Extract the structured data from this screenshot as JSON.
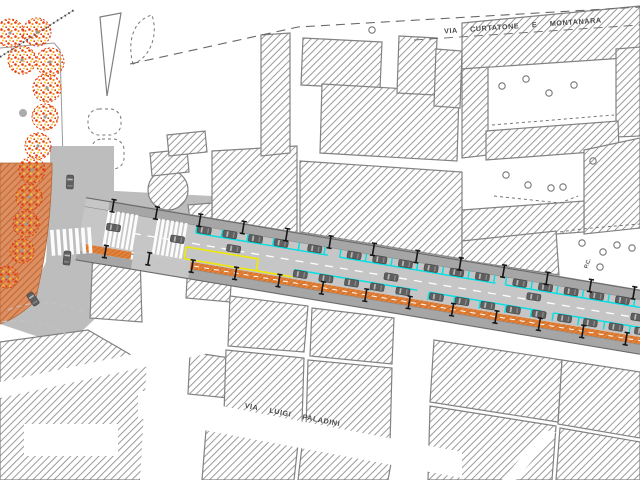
{
  "drawing": {
    "kind": "urban street redesign plan",
    "labels": {
      "street_top": "VIA CURTATONE E MONTANARA",
      "street_bottom": "VIA LUIGI PALADINI",
      "marker": "P.C."
    }
  },
  "colors": {
    "plaza": "#dd8f62",
    "plaza_hatch": "#c06a35",
    "bike": "#e2823a",
    "bike_hatch": "#c96a28",
    "parking_cyan": "#00dfe3",
    "bus_yellow": "#f0ea00",
    "road": "#c6c6c6",
    "sidewalk": "#a6a6a6",
    "junction": "#bdbdbd",
    "car_body": "#5f5f5f",
    "hatch_line": "#9a9a9a",
    "outline": "#828282",
    "tree_red": "#e23b0e",
    "tree_orange": "#f58a1f",
    "tree_yellow": "#f7c81e"
  },
  "map": {
    "road": {
      "origin_x": 88,
      "origin_y": 198,
      "angle_deg": 9.5,
      "length": 615
    },
    "parked_cars_north_x": [
      120,
      146,
      172,
      198,
      232,
      272,
      298,
      324,
      350,
      376,
      402,
      440,
      466,
      492,
      518,
      544,
      570
    ],
    "parked_cars_south_x": [
      222,
      248,
      274,
      300,
      326,
      360,
      386,
      412,
      438,
      464,
      490,
      516,
      542,
      568
    ],
    "moving_cars": [
      [
        30,
        25
      ],
      [
        95,
        26
      ],
      [
        152,
        26
      ],
      [
        312,
        28
      ],
      [
        456,
        24
      ],
      [
        562,
        27
      ]
    ],
    "road_trees_x": [
      26,
      70,
      114,
      158,
      202,
      246,
      290,
      334,
      378,
      422,
      466,
      510,
      554,
      598
    ],
    "parking_bays_north": [
      [
        112,
        246
      ],
      [
        258,
        416
      ],
      [
        426,
        586
      ]
    ],
    "parking_bays_south": [
      [
        216,
        340
      ],
      [
        352,
        466
      ],
      [
        478,
        586
      ]
    ],
    "crosswalks_local_x": [
      22,
      72
    ],
    "junction_cars": [
      [
        70,
        182,
        92
      ],
      [
        67,
        258,
        96
      ],
      [
        33,
        299,
        55
      ]
    ],
    "park_trees": [
      [
        10,
        33,
        14
      ],
      [
        37,
        32,
        14
      ],
      [
        22,
        60,
        14
      ],
      [
        50,
        62,
        14
      ],
      [
        47,
        88,
        14
      ],
      [
        45,
        117,
        13
      ],
      [
        38,
        146,
        13
      ]
    ],
    "plaza_trees": [
      [
        32,
        170,
        13
      ],
      [
        29,
        197,
        13
      ],
      [
        26,
        224,
        13
      ],
      [
        22,
        251,
        12
      ],
      [
        7,
        277,
        11
      ]
    ],
    "courtyard_circles": [
      [
        502,
        86
      ],
      [
        526,
        79
      ],
      [
        549,
        93
      ],
      [
        574,
        85
      ],
      [
        506,
        175
      ],
      [
        528,
        185
      ],
      [
        551,
        188
      ],
      [
        563,
        187
      ],
      [
        593,
        161
      ],
      [
        582,
        243
      ],
      [
        603,
        252
      ],
      [
        617,
        245
      ],
      [
        600,
        267
      ],
      [
        632,
        248
      ],
      [
        372,
        30
      ]
    ],
    "park_gray_dot": [
      23,
      113
    ]
  }
}
